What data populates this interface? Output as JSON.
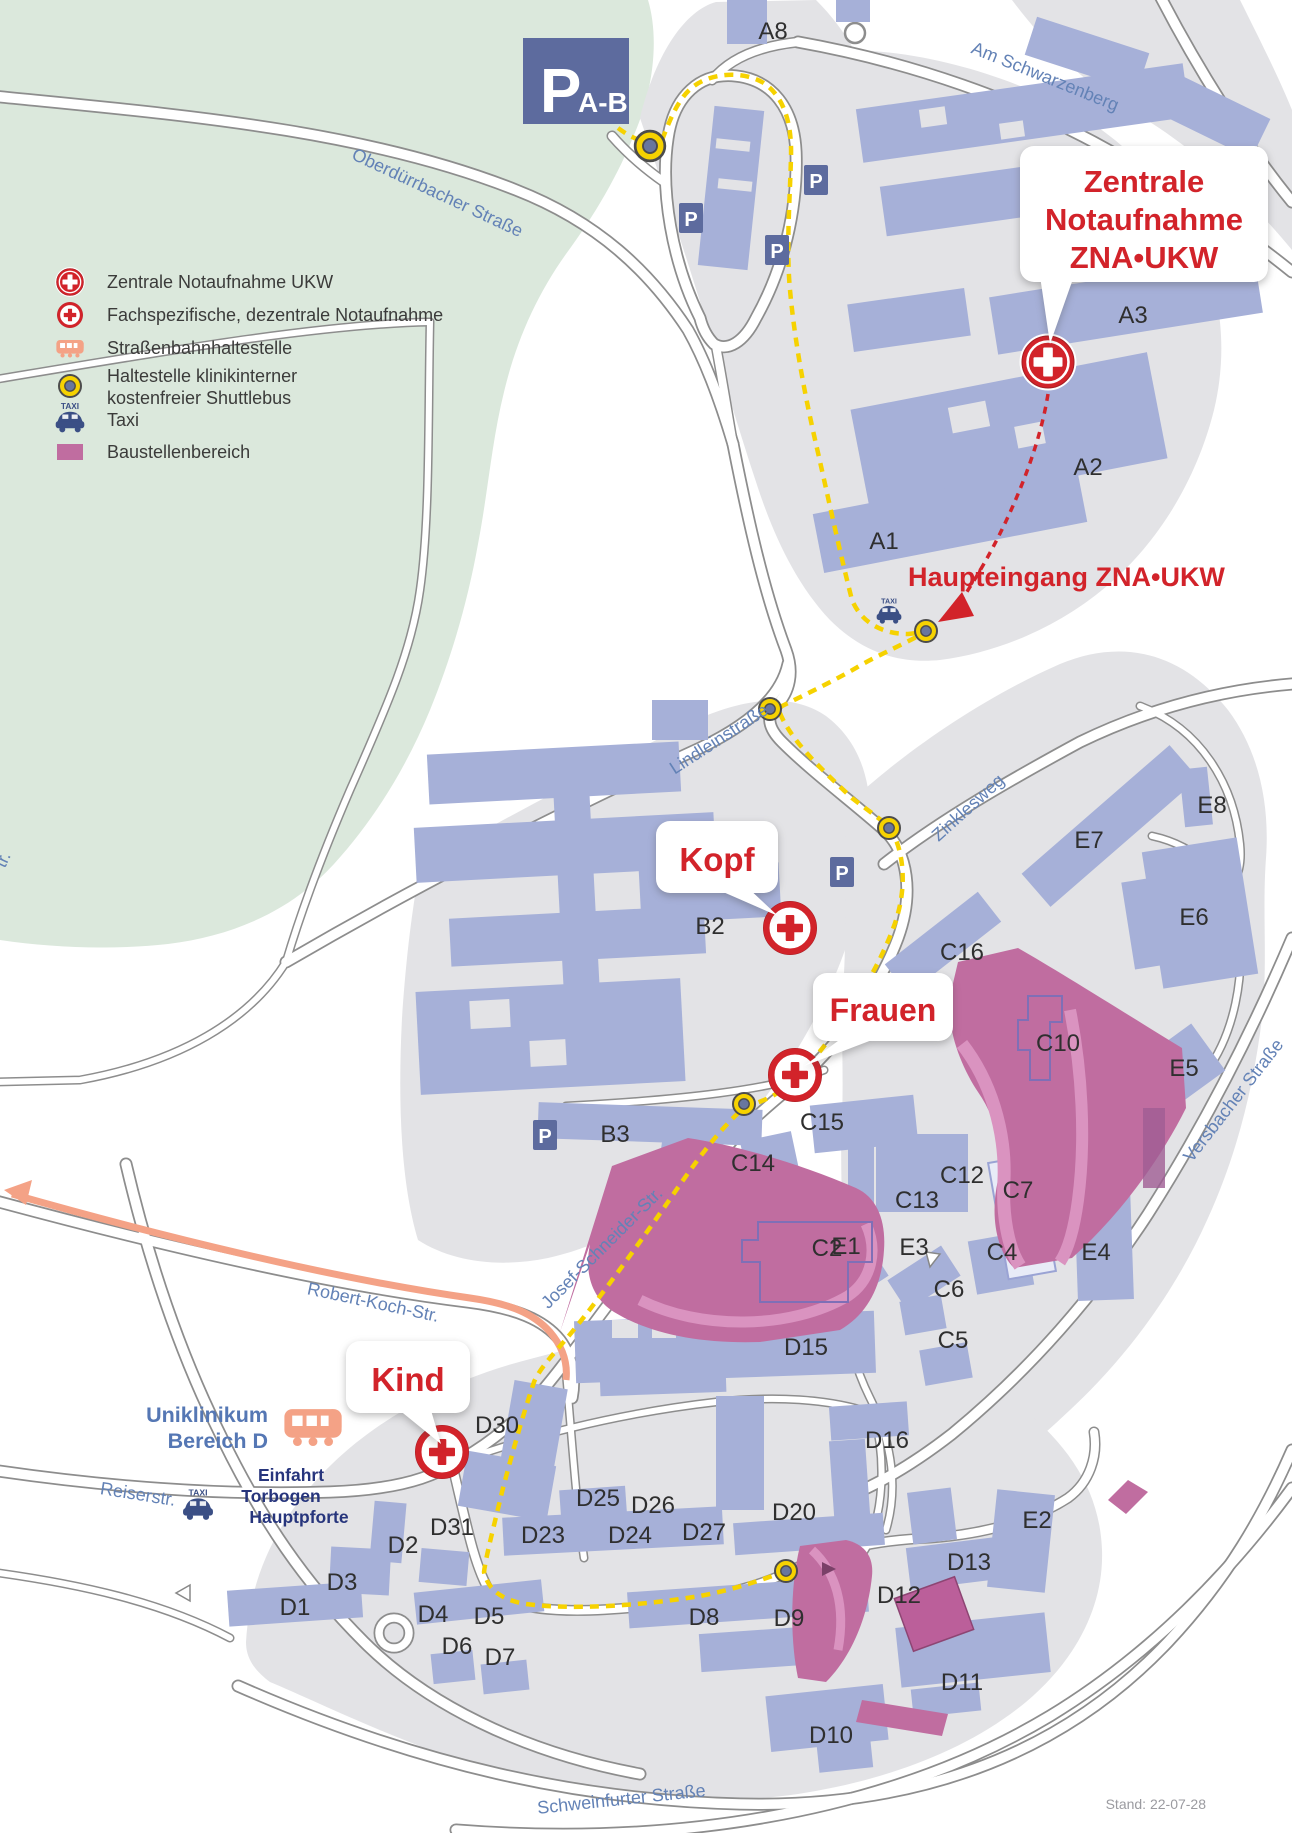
{
  "map": {
    "stand": "Stand: 22-07-28",
    "p_letter": "P",
    "taxi_icon_text": "TAXI",
    "parking_ab": {
      "p": "P",
      "sub": "A-B"
    },
    "haupteingang": "Haupteingang ZNA•UKW",
    "bubbles": {
      "zna": [
        "Zentrale",
        "Notaufnahme",
        "ZNA•UKW"
      ],
      "kopf": [
        "Kopf"
      ],
      "frauen": [
        "Frauen"
      ],
      "kind": [
        "Kind"
      ]
    },
    "area_d": [
      "Uniklinikum",
      "Bereich D"
    ],
    "entrance": [
      "Einfahrt",
      "Torbogen",
      "Hauptpforte"
    ],
    "legend": {
      "items": [
        {
          "icon": "marker-central",
          "y": 282,
          "s": 0.52,
          "lines": [
            "Zentrale Notaufnahme UKW"
          ]
        },
        {
          "icon": "marker-decentral",
          "y": 315,
          "s": 0.48,
          "lines": [
            "Fachspezifische, dezentrale Notaufnahme"
          ]
        },
        {
          "icon": "tram",
          "y": 348,
          "s": 0.62,
          "lines": [
            "Straßenbahnhaltestelle"
          ]
        },
        {
          "icon": "stop",
          "y": 386,
          "s": 1,
          "lines": [
            "Haltestelle klinikinterner",
            "kostenfreier Shuttlebus"
          ]
        },
        {
          "icon": "taxi",
          "y": 420,
          "s": 1.1,
          "lines": [
            "Taxi"
          ]
        },
        {
          "icon": "construction",
          "y": 452,
          "s": 1,
          "lines": [
            "Baustellenbereich"
          ]
        }
      ]
    },
    "streets": [
      [
        "Oberdürrbacher Straße",
        435,
        198,
        25
      ],
      [
        "Am Schwarzenberg",
        1043,
        82,
        22
      ],
      [
        "Lindleinstraße",
        722,
        744,
        -33
      ],
      [
        "Zinklesweg",
        972,
        812,
        -42
      ],
      [
        "Josef-Schneider-Str.",
        606,
        1252,
        -45
      ],
      [
        "Versbacher Straße",
        1238,
        1104,
        -52
      ],
      [
        "Robert-Koch-Str.",
        372,
        1308,
        12
      ],
      [
        "Reiserstr.",
        137,
        1500,
        9
      ],
      [
        "Schweinfurter Straße",
        622,
        1805,
        -6
      ],
      [
        "tr.",
        8,
        862,
        -65
      ]
    ],
    "buildings": [
      [
        "A8",
        773,
        30
      ],
      [
        "A3",
        1133,
        314
      ],
      [
        "A2",
        1088,
        466
      ],
      [
        "A1",
        884,
        540
      ],
      [
        "B2",
        710,
        925
      ],
      [
        "B3",
        615,
        1133
      ],
      [
        "C16",
        962,
        951
      ],
      [
        "C15",
        822,
        1121
      ],
      [
        "C14",
        753,
        1162
      ],
      [
        "C13",
        917,
        1199
      ],
      [
        "C12",
        962,
        1174
      ],
      [
        "C10",
        1058,
        1042
      ],
      [
        "C7",
        1018,
        1189
      ],
      [
        "C6",
        949,
        1288
      ],
      [
        "C5",
        953,
        1339
      ],
      [
        "C4",
        1002,
        1251
      ],
      [
        "C2",
        827,
        1247
      ],
      [
        "E8",
        1212,
        804
      ],
      [
        "E7",
        1089,
        839
      ],
      [
        "E6",
        1194,
        916
      ],
      [
        "E5",
        1184,
        1067
      ],
      [
        "E4",
        1096,
        1251
      ],
      [
        "E3",
        914,
        1246
      ],
      [
        "E2",
        1037,
        1519
      ],
      [
        "E1",
        846,
        1245
      ],
      [
        "D15",
        806,
        1346
      ],
      [
        "D16",
        887,
        1439
      ],
      [
        "D30",
        497,
        1424
      ],
      [
        "D31",
        452,
        1526
      ],
      [
        "D2",
        403,
        1544
      ],
      [
        "D3",
        342,
        1581
      ],
      [
        "D1",
        295,
        1606
      ],
      [
        "D4",
        433,
        1613
      ],
      [
        "D5",
        489,
        1615
      ],
      [
        "D6",
        457,
        1645
      ],
      [
        "D7",
        500,
        1656
      ],
      [
        "D25",
        598,
        1497
      ],
      [
        "D26",
        653,
        1504
      ],
      [
        "D23",
        543,
        1534
      ],
      [
        "D24",
        630,
        1534
      ],
      [
        "D27",
        704,
        1531
      ],
      [
        "D20",
        794,
        1511
      ],
      [
        "D8",
        704,
        1616
      ],
      [
        "D9",
        789,
        1617
      ],
      [
        "D10",
        831,
        1734
      ],
      [
        "D11",
        962,
        1681
      ],
      [
        "D12",
        899,
        1594
      ],
      [
        "D13",
        969,
        1561
      ]
    ],
    "shuttle_stops": [
      [
        650,
        146,
        1.35
      ],
      [
        926,
        631,
        1
      ],
      [
        770,
        709,
        1
      ],
      [
        889,
        828,
        1
      ],
      [
        744,
        1104,
        1
      ],
      [
        786,
        1571,
        1
      ]
    ],
    "p_signs": [
      [
        691,
        218
      ],
      [
        816,
        180
      ],
      [
        777,
        250
      ],
      [
        842,
        872
      ],
      [
        545,
        1135
      ]
    ],
    "taxis": [
      [
        889,
        613,
        0.95
      ],
      [
        198,
        1507,
        1.15
      ]
    ],
    "markers": {
      "central": [
        [
          1048,
          362
        ]
      ],
      "decentral": [
        [
          790,
          928
        ],
        [
          795,
          1075
        ],
        [
          442,
          1452
        ]
      ]
    }
  },
  "colors": {
    "accent_red": "#d2232a",
    "route_yellow": "#f6d200",
    "construction_pink": "#c06da0",
    "tram_orange": "#f4a286",
    "building_blue": "#a6b0d8",
    "street_text": "#6382b6",
    "parking_blue": "#5d6b9e"
  }
}
